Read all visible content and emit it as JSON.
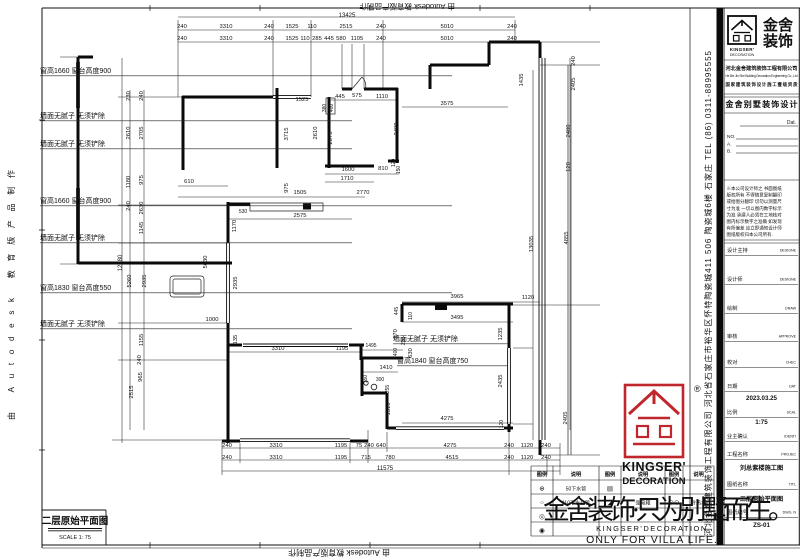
{
  "meta": {
    "autodesk_left": "由 Autodesk 教育版产品制作",
    "autodesk_top": "由 Autodesk 教育版产品制作",
    "autodesk_bottom": "由 Autodesk 教育版产品制作"
  },
  "plan": {
    "title": "二层原始平面图",
    "scale": "SCALE 1: 75",
    "dims": [
      {
        "t": "13425",
        "x": 347,
        "y": 17,
        "s": 6
      },
      {
        "t": "240",
        "x": 182,
        "y": 28
      },
      {
        "t": "3310",
        "x": 226,
        "y": 28
      },
      {
        "t": "240",
        "x": 269,
        "y": 28
      },
      {
        "t": "1525",
        "x": 292,
        "y": 28
      },
      {
        "t": "110",
        "x": 312,
        "y": 28
      },
      {
        "t": "2515",
        "x": 346,
        "y": 28
      },
      {
        "t": "240",
        "x": 381,
        "y": 28
      },
      {
        "t": "5010",
        "x": 447,
        "y": 28
      },
      {
        "t": "240",
        "x": 512,
        "y": 28
      },
      {
        "t": "240",
        "x": 182,
        "y": 40
      },
      {
        "t": "3310",
        "x": 226,
        "y": 40
      },
      {
        "t": "240",
        "x": 269,
        "y": 40
      },
      {
        "t": "1525",
        "x": 292,
        "y": 40
      },
      {
        "t": "110",
        "x": 305,
        "y": 40
      },
      {
        "t": "285",
        "x": 317,
        "y": 40
      },
      {
        "t": "445",
        "x": 329,
        "y": 40
      },
      {
        "t": "580",
        "x": 341,
        "y": 40
      },
      {
        "t": "1105",
        "x": 357,
        "y": 40
      },
      {
        "t": "240",
        "x": 381,
        "y": 40
      },
      {
        "t": "5010",
        "x": 447,
        "y": 40
      },
      {
        "t": "240",
        "x": 512,
        "y": 40
      },
      {
        "t": "240",
        "x": 227,
        "y": 447
      },
      {
        "t": "3310",
        "x": 276,
        "y": 447
      },
      {
        "t": "1195",
        "x": 341,
        "y": 447
      },
      {
        "t": "75",
        "x": 359,
        "y": 447
      },
      {
        "t": "240",
        "x": 369,
        "y": 447
      },
      {
        "t": "640",
        "x": 381,
        "y": 447
      },
      {
        "t": "4275",
        "x": 450,
        "y": 447
      },
      {
        "t": "240",
        "x": 509,
        "y": 447
      },
      {
        "t": "1120",
        "x": 527,
        "y": 447
      },
      {
        "t": "240",
        "x": 546,
        "y": 447
      },
      {
        "t": "240",
        "x": 227,
        "y": 459
      },
      {
        "t": "3310",
        "x": 276,
        "y": 459
      },
      {
        "t": "1195",
        "x": 341,
        "y": 459
      },
      {
        "t": "715",
        "x": 366,
        "y": 459
      },
      {
        "t": "780",
        "x": 390,
        "y": 459
      },
      {
        "t": "4515",
        "x": 452,
        "y": 459
      },
      {
        "t": "240",
        "x": 509,
        "y": 459
      },
      {
        "t": "1120",
        "x": 527,
        "y": 459
      },
      {
        "t": "240",
        "x": 546,
        "y": 459
      },
      {
        "t": "11575",
        "x": 385,
        "y": 470,
        "s": 6
      },
      {
        "t": "230",
        "x": 130,
        "y": 96,
        "r": 1
      },
      {
        "t": "240",
        "x": 143,
        "y": 96,
        "r": 1
      },
      {
        "t": "2610",
        "x": 130,
        "y": 133,
        "r": 1
      },
      {
        "t": "2705",
        "x": 143,
        "y": 133,
        "r": 1
      },
      {
        "t": "1180",
        "x": 130,
        "y": 182,
        "r": 1
      },
      {
        "t": "975",
        "x": 143,
        "y": 180,
        "r": 1
      },
      {
        "t": "240",
        "x": 130,
        "y": 206,
        "r": 1
      },
      {
        "t": "2630",
        "x": 143,
        "y": 208,
        "r": 1
      },
      {
        "t": "1145",
        "x": 143,
        "y": 228,
        "r": 1
      },
      {
        "t": "12280",
        "x": 122,
        "y": 263,
        "r": 1,
        "s": 6
      },
      {
        "t": "5260",
        "x": 131,
        "y": 281,
        "r": 1
      },
      {
        "t": "2935",
        "x": 146,
        "y": 281,
        "r": 1
      },
      {
        "t": "1155",
        "x": 143,
        "y": 340,
        "r": 1
      },
      {
        "t": "240",
        "x": 141,
        "y": 360,
        "r": 1
      },
      {
        "t": "965",
        "x": 142,
        "y": 377,
        "r": 1
      },
      {
        "t": "2515",
        "x": 133,
        "y": 392,
        "r": 1
      },
      {
        "t": "1525",
        "x": 302,
        "y": 101
      },
      {
        "t": "445",
        "x": 340,
        "y": 98
      },
      {
        "t": "575",
        "x": 357,
        "y": 97
      },
      {
        "t": "1110",
        "x": 382,
        "y": 98
      },
      {
        "t": "380",
        "x": 326,
        "y": 108,
        "r": 1,
        "s": 5
      },
      {
        "t": "400",
        "x": 333,
        "y": 108,
        "r": 1,
        "s": 5
      },
      {
        "t": "3715",
        "x": 288,
        "y": 134,
        "r": 1
      },
      {
        "t": "2610",
        "x": 317,
        "y": 133,
        "r": 1
      },
      {
        "t": "2075",
        "x": 332,
        "y": 138,
        "r": 1
      },
      {
        "t": "2480",
        "x": 398,
        "y": 129,
        "r": 1
      },
      {
        "t": "3575",
        "x": 447,
        "y": 105
      },
      {
        "t": "1435",
        "x": 523,
        "y": 80,
        "r": 1
      },
      {
        "t": "1600",
        "x": 348,
        "y": 171
      },
      {
        "t": "810",
        "x": 383,
        "y": 170
      },
      {
        "t": "120",
        "x": 395,
        "y": 163,
        "r": 1,
        "s": 5
      },
      {
        "t": "150",
        "x": 400,
        "y": 170,
        "r": 1,
        "s": 5
      },
      {
        "t": "1710",
        "x": 347,
        "y": 180
      },
      {
        "t": "610",
        "x": 189,
        "y": 183
      },
      {
        "t": "975",
        "x": 288,
        "y": 188,
        "r": 1
      },
      {
        "t": "1505",
        "x": 300,
        "y": 194
      },
      {
        "t": "2770",
        "x": 363,
        "y": 194
      },
      {
        "t": "530",
        "x": 243,
        "y": 213,
        "s": 5
      },
      {
        "t": "2575",
        "x": 300,
        "y": 217
      },
      {
        "t": "1170",
        "x": 236,
        "y": 226,
        "r": 1
      },
      {
        "t": "5630",
        "x": 207,
        "y": 262,
        "r": 1
      },
      {
        "t": "2935",
        "x": 237,
        "y": 283,
        "r": 1
      },
      {
        "t": "1000",
        "x": 212,
        "y": 321
      },
      {
        "t": "1135",
        "x": 237,
        "y": 341,
        "r": 1
      },
      {
        "t": "240",
        "x": 575,
        "y": 61,
        "r": 1
      },
      {
        "t": "2405",
        "x": 575,
        "y": 84,
        "r": 1
      },
      {
        "t": "2480",
        "x": 570,
        "y": 131,
        "r": 1
      },
      {
        "t": "120",
        "x": 570,
        "y": 167,
        "r": 1
      },
      {
        "t": "4855",
        "x": 568,
        "y": 238,
        "r": 1
      },
      {
        "t": "13035",
        "x": 533,
        "y": 244,
        "r": 1
      },
      {
        "t": "2405",
        "x": 567,
        "y": 418,
        "r": 1
      },
      {
        "t": "3965",
        "x": 457,
        "y": 298
      },
      {
        "t": "1120",
        "x": 528,
        "y": 299
      },
      {
        "t": "3495",
        "x": 457,
        "y": 319
      },
      {
        "t": "110",
        "x": 412,
        "y": 316,
        "r": 1,
        "s": 5
      },
      {
        "t": "445",
        "x": 398,
        "y": 311,
        "r": 1,
        "s": 5
      },
      {
        "t": "970",
        "x": 397,
        "y": 334,
        "r": 1
      },
      {
        "t": "230",
        "x": 405,
        "y": 341,
        "r": 1,
        "s": 5
      },
      {
        "t": "400",
        "x": 397,
        "y": 352,
        "r": 1,
        "s": 5
      },
      {
        "t": "630",
        "x": 412,
        "y": 353,
        "r": 1
      },
      {
        "t": "1495",
        "x": 371,
        "y": 347,
        "s": 5
      },
      {
        "t": "1410",
        "x": 386,
        "y": 369
      },
      {
        "t": "150",
        "x": 367,
        "y": 379,
        "r": 1,
        "s": 5
      },
      {
        "t": "300",
        "x": 380,
        "y": 381,
        "s": 5
      },
      {
        "t": "255",
        "x": 389,
        "y": 389,
        "r": 1,
        "s": 5
      },
      {
        "t": "1310",
        "x": 390,
        "y": 409,
        "r": 1
      },
      {
        "t": "1235",
        "x": 502,
        "y": 334,
        "r": 1
      },
      {
        "t": "2435",
        "x": 502,
        "y": 381,
        "r": 1
      },
      {
        "t": "4275",
        "x": 447,
        "y": 420
      },
      {
        "t": "120",
        "x": 503,
        "y": 424,
        "r": 1,
        "s": 5
      },
      {
        "t": "3310",
        "x": 278,
        "y": 350
      },
      {
        "t": "1195",
        "x": 342,
        "y": 350
      }
    ],
    "annotations": [
      {
        "t": "窗高1660  窗台高度900",
        "x": 40,
        "y": 73,
        "x2": 452
      },
      {
        "t": "墙面无腻子 无须铲除",
        "x": 40,
        "y": 118,
        "x2": 352
      },
      {
        "t": "墙面无腻子 无须铲除",
        "x": 40,
        "y": 146,
        "x2": 352
      },
      {
        "t": "窗高1660  窗台高度900",
        "x": 40,
        "y": 203,
        "x2": 452
      },
      {
        "t": "墙面无腻子 无须铲除",
        "x": 40,
        "y": 240,
        "x2": 352
      },
      {
        "t": "窗高1830  窗台高度550",
        "x": 40,
        "y": 290,
        "x2": 452
      },
      {
        "t": "墙面无腻子 无须铲除",
        "x": 40,
        "y": 326,
        "x2": 352
      },
      {
        "t": "墙面无腻子 无须铲除",
        "x": 393,
        "y": 341,
        "x2": 508
      },
      {
        "t": "窗高1840  窗台高度750",
        "x": 397,
        "y": 363,
        "x2": 508
      }
    ]
  },
  "legend": {
    "headers": [
      "图例",
      "说明",
      "图例",
      "说明",
      "图例",
      "说明"
    ],
    "rows": [
      [
        "⊕",
        "50下水管",
        "▤",
        "",
        "",
        ""
      ],
      [
        "○",
        "110下水立管",
        "◢",
        "强电箱",
        "⊙⊙",
        "冷热水"
      ],
      [
        "◎",
        "",
        "",
        "",
        "",
        ""
      ],
      [
        "◉",
        "",
        "",
        "",
        "",
        ""
      ]
    ]
  },
  "brand": {
    "watermark_cn": "金舍装饰·只为别墅而生。",
    "watermark_en1": "KINGSER'DECORATION",
    "watermark_en2": "ONLY FOR VILLA LIFE.",
    "red_logo_kingser": "KINGSER'",
    "red_logo_decoration": "DECORATION",
    "reg_mark": "®"
  },
  "titleblock": {
    "logo_cn1": "金舍",
    "logo_cn2": "装饰",
    "logo_en1": "KINGSER'",
    "logo_en2": "DECORATION",
    "company": "河北金舍建筑装饰工程有限公司",
    "company_en": "He Bei Jin She Building Decoration Engineering Co., Ltd",
    "qualification": "国家建筑装饰设计施工壹级资质",
    "product": "金舍别墅装饰设计",
    "dat_label": "Dat.",
    "no_label": "NO.",
    "a_label": "A.",
    "b_label": "B.",
    "notice_lines": [
      "※本公司设计师之 书面图纸",
      "版权所有 不得随意复制翻印",
      "或给图分翻印 切勿以测量尺",
      "寸为准 一切以图内数字标示",
      "为准 承建人必须在工地核对",
      "图内标示数字之准确 如发现",
      "有所偏差 应立即通知设计师",
      "图纸版权归本公司所有."
    ],
    "fields": [
      {
        "label": "设计主持",
        "en": "DESIGNE",
        "value": ""
      },
      {
        "label": "设计师",
        "en": "DESIGNE",
        "value": ""
      },
      {
        "label": "绘制",
        "en": "DRAW",
        "value": ""
      },
      {
        "label": "审核",
        "en": "APPROVE",
        "value": ""
      },
      {
        "label": "校对",
        "en": "CHEC",
        "value": ""
      },
      {
        "label": "日期",
        "en": "DAT",
        "value": "2023.03.25"
      },
      {
        "label": "比例",
        "en": "SCAL",
        "value": "1:75"
      },
      {
        "label": "业主确认",
        "en": "IDENTI",
        "value": ""
      },
      {
        "label": "工程名称",
        "en": "PROJEC",
        "value": "刘总紫楼施工图"
      },
      {
        "label": "图纸名称",
        "en": "TITL",
        "value": "二层原始平面图"
      },
      {
        "label": "图纸编号",
        "en": "DWG. N",
        "value": "ZS-01"
      }
    ],
    "address_vertical": "河北金舍建筑装饰工程有限公司 河北省石家庄市裕华区怀特陶瓷城411 506 陶瓷城6楼 石家庄 TEL (86) 0311-88995555"
  }
}
